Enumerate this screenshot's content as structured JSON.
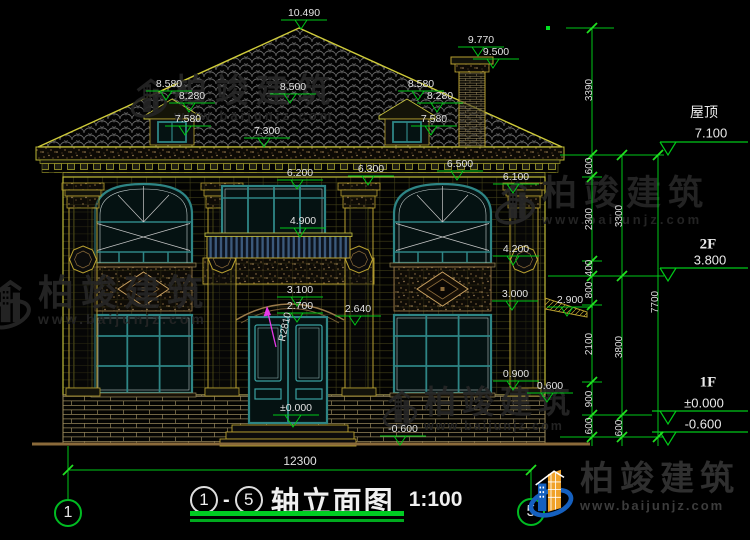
{
  "watermark": {
    "brand": "柏竣建筑",
    "url": "www.baijunjz.com"
  },
  "titlebar": {
    "axis_from": "1",
    "axis_to": "5",
    "dash": "-",
    "title": "轴立面图",
    "scale": "1:100"
  },
  "axes": {
    "left": "1",
    "right": "5"
  },
  "levels": {
    "peak": "10.490",
    "chimney_top": "9.770",
    "chimney_cap": "9.500",
    "dormer_left_ridge": "8.580",
    "dormer_left_eave": "8.280",
    "dormer_left_sill": "7.580",
    "roof_mid": "8.500",
    "dormer_right_ridge": "8.580",
    "dormer_right_eave": "8.280",
    "dormer_right_sill": "7.580",
    "eave_top": "7.300",
    "cornice_bottom": "6.500",
    "balcony_window_top": "6.200",
    "frieze_right": "6.300",
    "pilaster_capital": "6.100",
    "balcony_rail": "4.900",
    "panel_top": "4.200",
    "arch_top": "3.100",
    "door_top": "2.700",
    "arch_spring": "2.640",
    "window_top_1f": "3.000",
    "porch_roof": "2.900",
    "sill_1f": "0.900",
    "base_top": "0.600",
    "grade": "-0.600",
    "door_floor": "±0.000"
  },
  "right_panel": {
    "roof_label": "屋顶",
    "roof_level": "7.100",
    "f2_label": "2F",
    "f2_level": "3.800",
    "f1_label": "1F",
    "f1_zero": "±0.000",
    "f1_below": "-0.600"
  },
  "chains": {
    "a": [
      "3390",
      "600",
      "2300",
      "400",
      "800",
      "2100",
      "900",
      "600"
    ],
    "b": [
      "3300",
      "3800",
      "600"
    ],
    "c": [
      "7700"
    ],
    "width": "12300"
  },
  "annotations": {
    "radius": "R2810"
  }
}
